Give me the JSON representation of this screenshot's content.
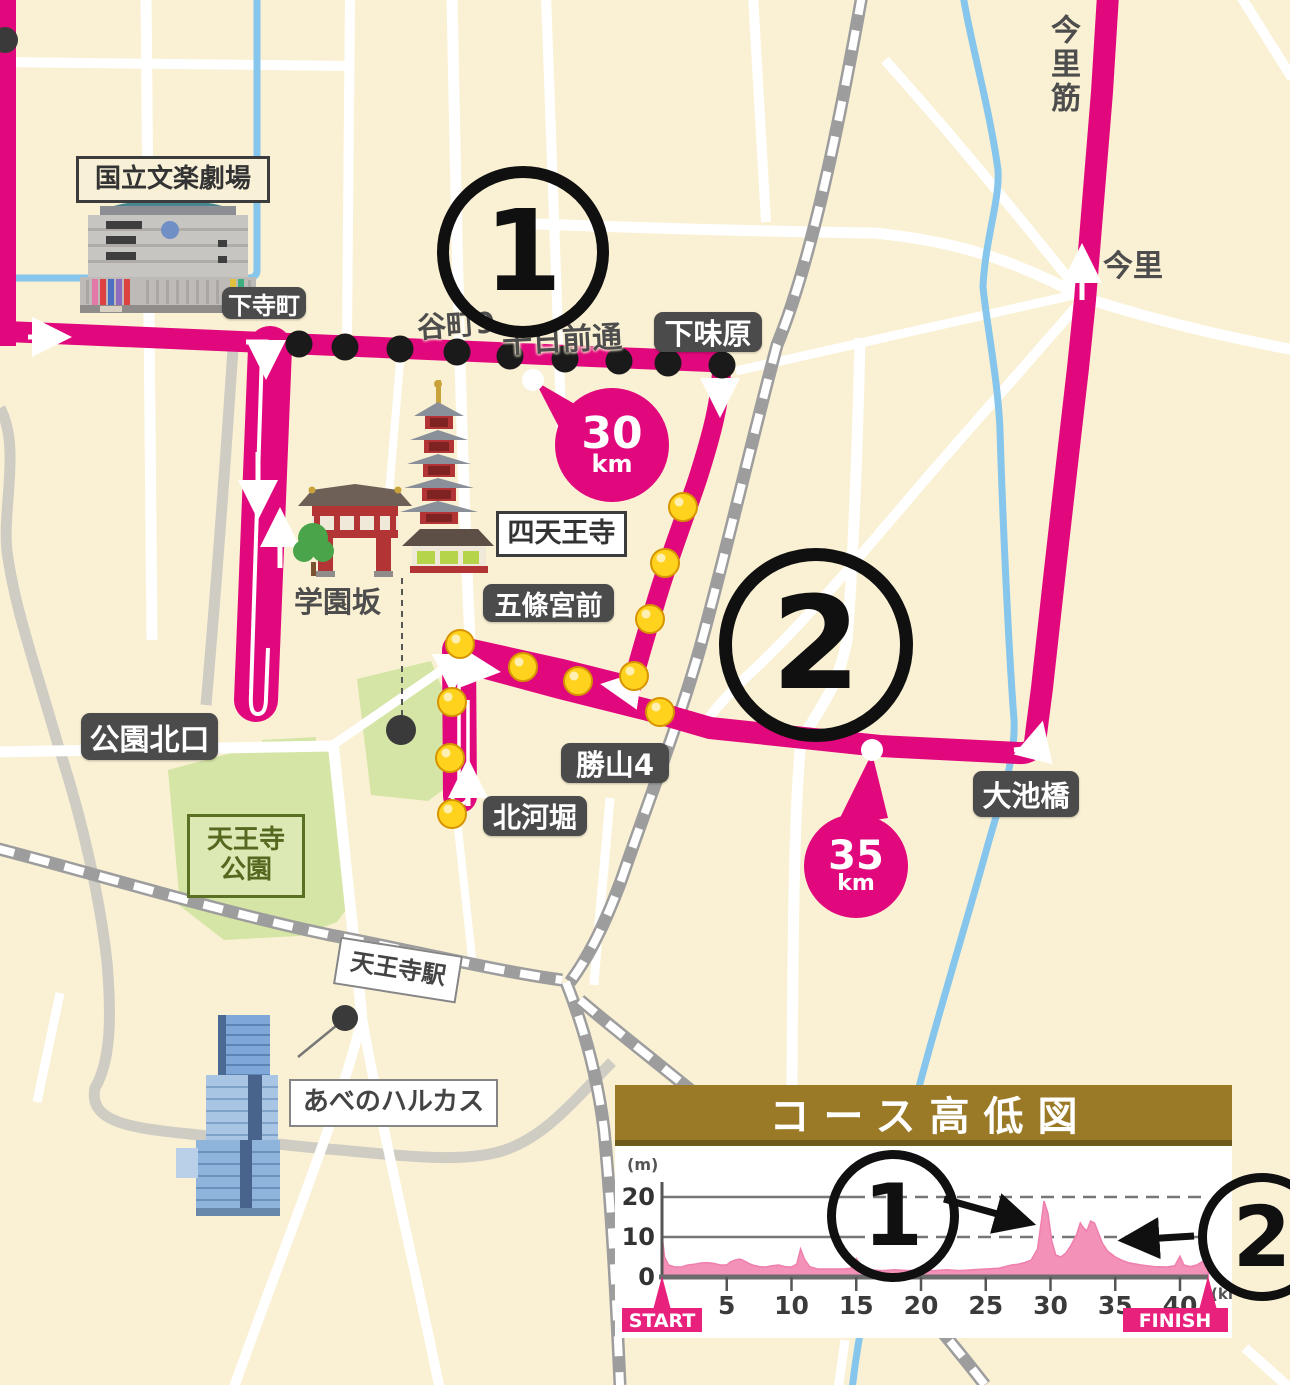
{
  "map": {
    "colors": {
      "background": "#FAF1D4",
      "route_pink": "#E1077C",
      "road_white": "#FFFFFF",
      "road_gray": "#CFCCC4",
      "railway_gray": "#9D9D9D",
      "river_blue": "#86C5EC",
      "park_green": "#D5E5A5",
      "label_pill_bg": "#4B4B4B",
      "marker_yellow": "#FFD21D",
      "marker_black": "#1A1A1A",
      "chart_header_brown": "#9A7A27",
      "chart_profile_pink": "#F391B9",
      "start_finish_pink": "#E8217D"
    },
    "station_pills": [
      {
        "name": "station-pill-shimoteramachi",
        "label": "下寺町",
        "x": 222,
        "y": 287,
        "w": 84,
        "h": 32,
        "font": 24
      },
      {
        "name": "station-pill-shimoajihara",
        "label": "下味原",
        "x": 654,
        "y": 312,
        "w": 108,
        "h": 40,
        "font": 29
      },
      {
        "name": "station-pill-gojogumae",
        "label": "五條宮前",
        "x": 483,
        "y": 584,
        "w": 131,
        "h": 38,
        "font": 27
      },
      {
        "name": "station-pill-katsuyama4",
        "label": "勝山4",
        "x": 561,
        "y": 743,
        "w": 108,
        "h": 40,
        "font": 29
      },
      {
        "name": "station-pill-kitakawahori",
        "label": "北河堀",
        "x": 483,
        "y": 796,
        "w": 104,
        "h": 40,
        "font": 28
      },
      {
        "name": "station-pill-koenkitaguchi",
        "label": "公園北口",
        "x": 81,
        "y": 713,
        "w": 137,
        "h": 47,
        "font": 30
      },
      {
        "name": "station-pill-oikebashi",
        "label": "大池橋",
        "x": 973,
        "y": 771,
        "w": 106,
        "h": 46,
        "font": 29
      }
    ],
    "street_names": [
      {
        "name": "street-tanimachi9",
        "label": "谷町9",
        "x": 417,
        "y": 302,
        "font": 29,
        "rot": -4
      },
      {
        "name": "street-sennichimae-dori",
        "label": "千日前通",
        "x": 502,
        "y": 315,
        "font": 30,
        "rot": -3
      },
      {
        "name": "street-gakuenzaka",
        "label": "学園坂",
        "x": 294,
        "y": 579,
        "font": 29,
        "rot": 0
      },
      {
        "name": "street-imazato",
        "label": "今里",
        "x": 1103,
        "y": 241,
        "font": 30,
        "rot": 0
      },
      {
        "name": "street-imazatosuji",
        "label": "今里筋",
        "x": 1040,
        "y": 14,
        "font": 30,
        "rot": 0,
        "vertical": true
      }
    ],
    "info_boxes": [
      {
        "name": "infobox-national-bunraku-theatre",
        "label": "国立文楽劇場",
        "x": 76,
        "y": 156,
        "w": 188,
        "h": 41,
        "font": 26,
        "style": "cream"
      },
      {
        "name": "infobox-shitennoji",
        "label": "四天王寺",
        "x": 496,
        "y": 511,
        "w": 125,
        "h": 40,
        "font": 27,
        "style": "white"
      },
      {
        "name": "infobox-abeno-harukas",
        "label": "あべのハルカス",
        "x": 289,
        "y": 1079,
        "w": 205,
        "h": 44,
        "font": 26,
        "style": "whitelt"
      },
      {
        "name": "infobox-tennoji-station",
        "label": "天王寺駅",
        "x": 336,
        "y": 946,
        "w": 120,
        "h": 44,
        "font": 24,
        "style": "whitelt",
        "rot": 9
      },
      {
        "name": "infobox-tennoji-park",
        "label": "天王寺\n公園",
        "x": 187,
        "y": 814,
        "w": 112,
        "h": 78,
        "font": 26,
        "style": "green"
      }
    ],
    "km_markers": [
      {
        "name": "km-marker-30",
        "num": "30",
        "unit": "km",
        "cx": 612,
        "cy": 445,
        "r": 57,
        "numfont": 44,
        "unitfont": 24
      },
      {
        "name": "km-marker-35",
        "num": "35",
        "unit": "km",
        "cx": 856,
        "cy": 866,
        "r": 52,
        "numfont": 40,
        "unitfont": 22
      }
    ],
    "circled_numbers": [
      {
        "name": "circled-number-1-map",
        "value": "1",
        "cx": 511,
        "cy": 240,
        "r": 74,
        "ring": 12,
        "font": 112
      },
      {
        "name": "circled-number-2-map",
        "value": "2",
        "cx": 803,
        "cy": 632,
        "r": 84,
        "ring": 13,
        "font": 128
      },
      {
        "name": "circled-number-1-chart",
        "value": "1",
        "cx": 884,
        "cy": 1207,
        "r": 57,
        "ring": 9,
        "font": 86
      },
      {
        "name": "circled-number-2-chart",
        "value": "2",
        "cx": 1253,
        "cy": 1228,
        "r": 55,
        "ring": 9,
        "font": 84
      }
    ],
    "route_dots_black": [
      [
        299,
        344
      ],
      [
        345,
        347
      ],
      [
        400,
        349
      ],
      [
        457,
        352
      ],
      [
        510,
        356
      ],
      [
        565,
        359
      ],
      [
        619,
        361
      ],
      [
        668,
        363
      ],
      [
        722,
        365
      ]
    ],
    "route_dots_yellow": [
      [
        683,
        507
      ],
      [
        665,
        563
      ],
      [
        650,
        619
      ],
      [
        634,
        676
      ],
      [
        578,
        681
      ],
      [
        523,
        667
      ],
      [
        460,
        644
      ],
      [
        452,
        702
      ],
      [
        450,
        758
      ],
      [
        452,
        814
      ],
      [
        660,
        712
      ]
    ],
    "poi_dots": [
      [
        5,
        40,
        13
      ],
      [
        401,
        730,
        15
      ],
      [
        345,
        1018,
        13
      ]
    ]
  },
  "chart_data": {
    "type": "area",
    "title": "コース高低図",
    "xlabel": "(km)",
    "ylabel": "(m)",
    "x_ticks": [
      5,
      10,
      15,
      20,
      25,
      30,
      35,
      40
    ],
    "y_ticks": [
      0,
      10,
      20
    ],
    "xlim": [
      0,
      42.2
    ],
    "ylim": [
      0,
      24
    ],
    "grid": "dashed-right",
    "start_label": "START",
    "finish_label": "FINISH",
    "annotations": [
      {
        "label": "1",
        "meaning": "hill at about 30 km",
        "points_to_km": 30
      },
      {
        "label": "2",
        "meaning": "hill at about 33 km",
        "points_to_km": 33
      }
    ],
    "series": [
      {
        "name": "elevation",
        "x": [
          0,
          0.2,
          0.5,
          1,
          1.5,
          2,
          2.5,
          3,
          3.5,
          4,
          4.5,
          5,
          5.3,
          5.7,
          6,
          6.3,
          6.7,
          7,
          7.5,
          8,
          8.5,
          9,
          9.5,
          10,
          10.4,
          10.7,
          11,
          11.4,
          12,
          13,
          14,
          14.6,
          15,
          15.3,
          15.7,
          16,
          17,
          18,
          19,
          20,
          21,
          22,
          23,
          24,
          25,
          26,
          26.5,
          27,
          27.5,
          28,
          28.5,
          29,
          29.3,
          29.5,
          29.8,
          30.1,
          30.4,
          30.8,
          31.2,
          31.6,
          32,
          32.3,
          32.5,
          32.8,
          33.1,
          33.4,
          33.7,
          34,
          34.4,
          35,
          35.5,
          36,
          37,
          38,
          39,
          39.6,
          40,
          40.3,
          40.8,
          41.3,
          41.8,
          42,
          42.2
        ],
        "y": [
          10.5,
          5,
          3,
          2.5,
          2.5,
          3,
          3.2,
          3.5,
          3.6,
          3.4,
          3,
          3,
          3.8,
          4.3,
          4.5,
          4.1,
          3.4,
          3,
          2.6,
          2.5,
          2.8,
          3,
          2.6,
          2.5,
          3.2,
          7,
          4.5,
          2.6,
          2,
          2,
          2,
          2.2,
          4.6,
          3.2,
          2.2,
          1.8,
          1.6,
          1.8,
          1.6,
          1.8,
          1.6,
          1.8,
          1.6,
          1.8,
          2,
          2.2,
          2.6,
          3,
          3.2,
          3.6,
          4.2,
          7,
          14,
          19,
          16,
          9,
          5.5,
          5,
          6,
          8,
          10.5,
          13.5,
          12.5,
          11.5,
          14,
          13.5,
          11,
          8.5,
          6.5,
          5,
          4.2,
          3.6,
          3,
          2.6,
          2.5,
          2.8,
          5.2,
          3,
          2.6,
          3,
          4,
          5.5,
          4
        ]
      }
    ]
  }
}
